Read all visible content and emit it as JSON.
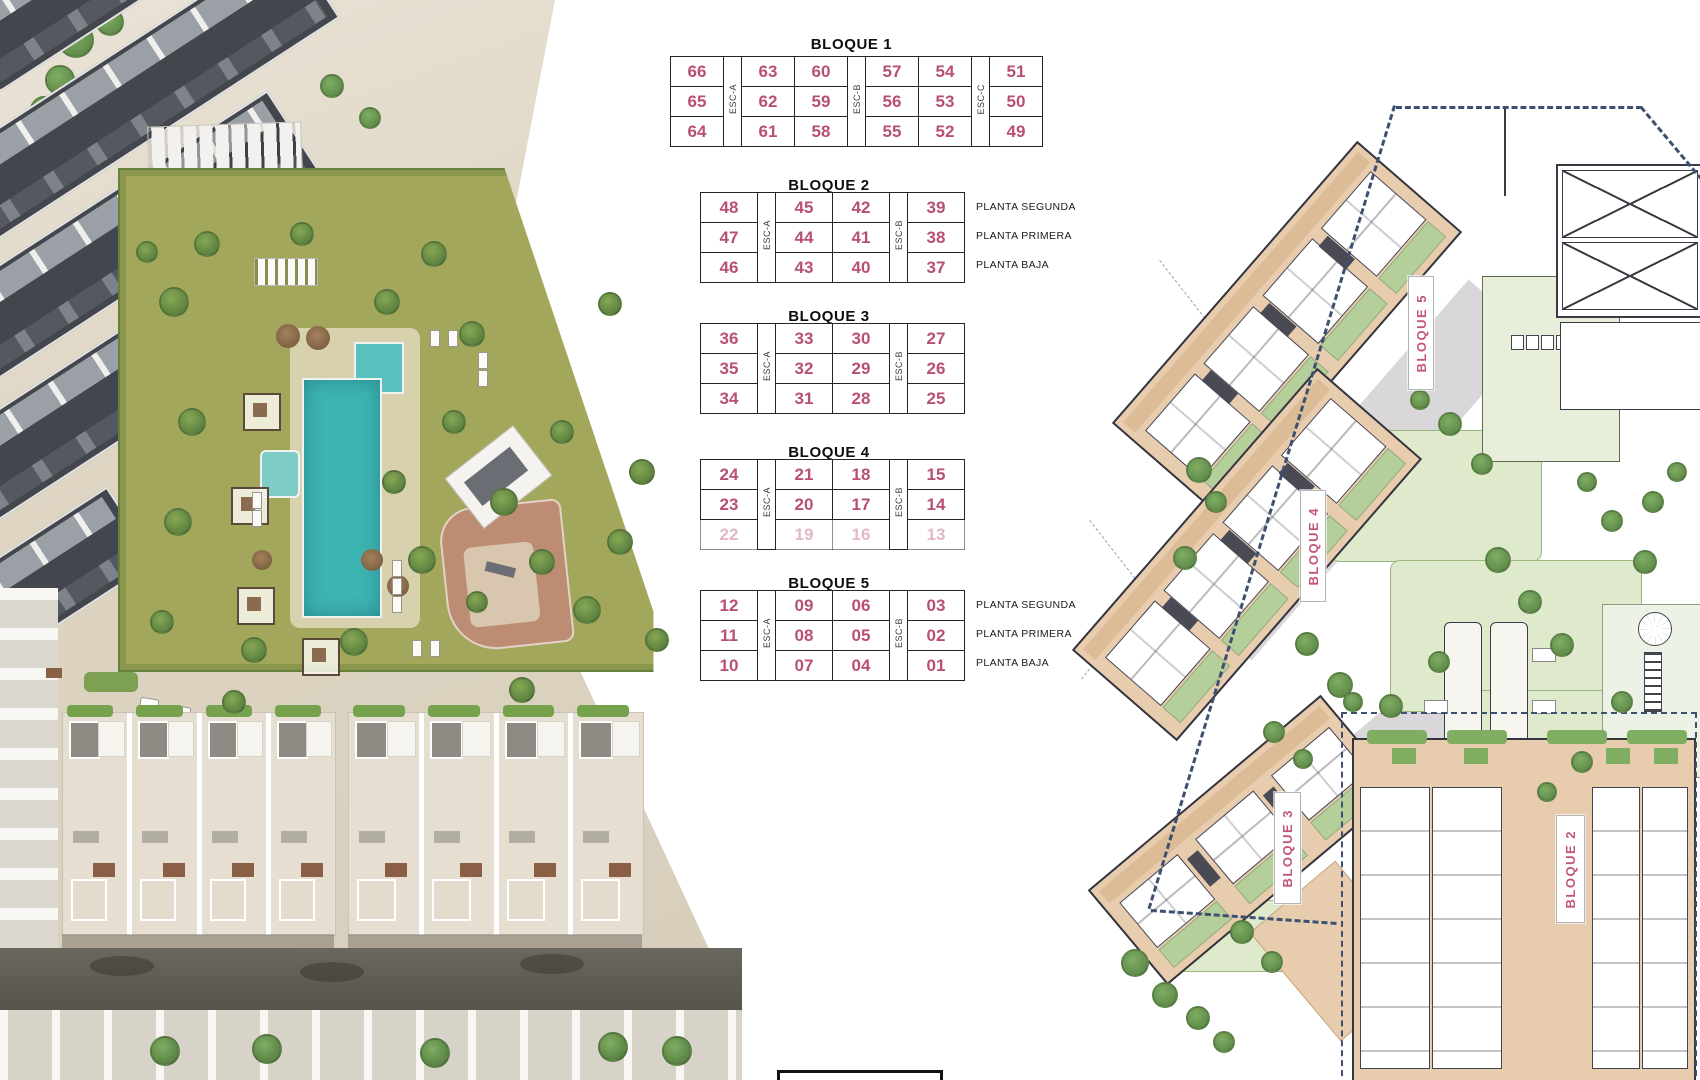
{
  "colors": {
    "unit_number": "#b85171",
    "accent_label": "#c2567a",
    "boundary": "#3e5071",
    "building_fill": "#e8ccae",
    "pool": "#3db3b2",
    "grass": "#a3a75b"
  },
  "unit_tables": {
    "blocks": [
      {
        "title": "BLOQUE 1",
        "stairs": [
          {
            "after": 0,
            "label": "ESC-A"
          },
          {
            "after": 2,
            "label": "ESC-B"
          },
          {
            "after": 4,
            "label": "ESC-C"
          }
        ],
        "rows": [
          [
            "66",
            "63",
            "60",
            "57",
            "54",
            "51"
          ],
          [
            "65",
            "62",
            "59",
            "56",
            "53",
            "50"
          ],
          [
            "64",
            "61",
            "58",
            "55",
            "52",
            "49"
          ]
        ],
        "row_labels": [],
        "faded_rows": []
      },
      {
        "title": "BLOQUE 2",
        "stairs": [
          {
            "after": 0,
            "label": "ESC-A"
          },
          {
            "after": 2,
            "label": "ESC-B"
          }
        ],
        "rows": [
          [
            "48",
            "45",
            "42",
            "39"
          ],
          [
            "47",
            "44",
            "41",
            "38"
          ],
          [
            "46",
            "43",
            "40",
            "37"
          ]
        ],
        "row_labels": [
          "PLANTA SEGUNDA",
          "PLANTA PRIMERA",
          "PLANTA BAJA"
        ],
        "faded_rows": []
      },
      {
        "title": "BLOQUE 3",
        "stairs": [
          {
            "after": 0,
            "label": "ESC-A"
          },
          {
            "after": 2,
            "label": "ESC-B"
          }
        ],
        "rows": [
          [
            "36",
            "33",
            "30",
            "27"
          ],
          [
            "35",
            "32",
            "29",
            "26"
          ],
          [
            "34",
            "31",
            "28",
            "25"
          ]
        ],
        "row_labels": [],
        "faded_rows": []
      },
      {
        "title": "BLOQUE 4",
        "stairs": [
          {
            "after": 0,
            "label": "ESC-A"
          },
          {
            "after": 2,
            "label": "ESC-B"
          }
        ],
        "rows": [
          [
            "24",
            "21",
            "18",
            "15"
          ],
          [
            "23",
            "20",
            "17",
            "14"
          ],
          [
            "22",
            "19",
            "16",
            "13"
          ]
        ],
        "row_labels": [],
        "faded_rows": [
          2
        ]
      },
      {
        "title": "BLOQUE 5",
        "stairs": [
          {
            "after": 0,
            "label": "ESC-A"
          },
          {
            "after": 2,
            "label": "ESC-B"
          }
        ],
        "rows": [
          [
            "12",
            "09",
            "06",
            "03"
          ],
          [
            "11",
            "08",
            "05",
            "02"
          ],
          [
            "10",
            "07",
            "04",
            "01"
          ]
        ],
        "row_labels": [
          "PLANTA SEGUNDA",
          "PLANTA PRIMERA",
          "PLANTA BAJA"
        ],
        "faded_rows": []
      }
    ]
  },
  "site_plan": {
    "building_labels": [
      "BLOQUE 5",
      "BLOQUE 4",
      "BLOQUE 3",
      "BLOQUE 2"
    ]
  }
}
